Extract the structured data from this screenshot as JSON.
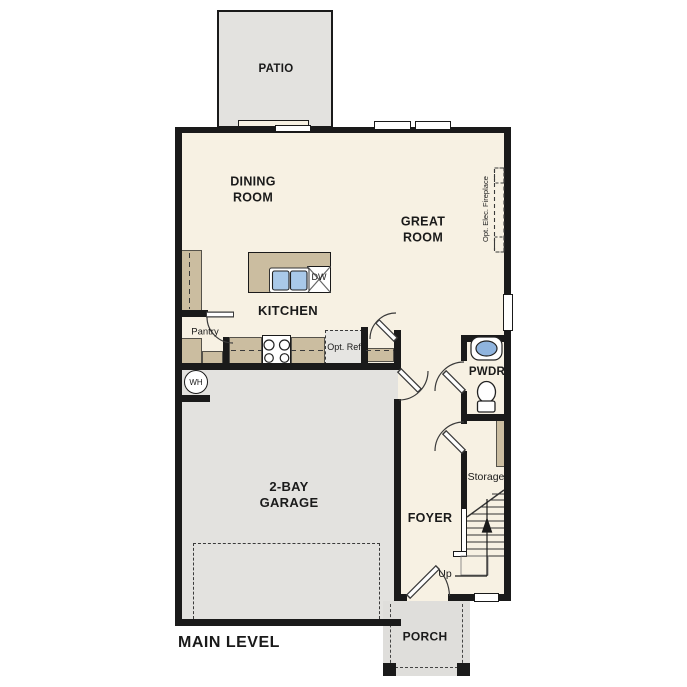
{
  "floorplan": {
    "level_title": "MAIN LEVEL",
    "rooms": {
      "patio": "PATIO",
      "dining_room": "DINING ROOM",
      "great_room": "GREAT ROOM",
      "kitchen": "KITCHEN",
      "powder_room": "PWDR",
      "garage": "2-BAY GARAGE",
      "foyer": "FOYER",
      "porch": "PORCH"
    },
    "annotations": {
      "pantry": "Pantry",
      "optional_refrigerator": "Opt. Ref",
      "dishwasher": "DW",
      "water_heater": "WH",
      "storage": "Storage",
      "stairs_up": "Up",
      "optional_fireplace": "Opt. Elec. Fireplace"
    },
    "colors": {
      "floor": "#f7f1e3",
      "hardscape": "#e3e2df",
      "casework": "#cbbda0",
      "wall": "#1a1a1a",
      "sink_water": "#a9c9e9"
    }
  }
}
